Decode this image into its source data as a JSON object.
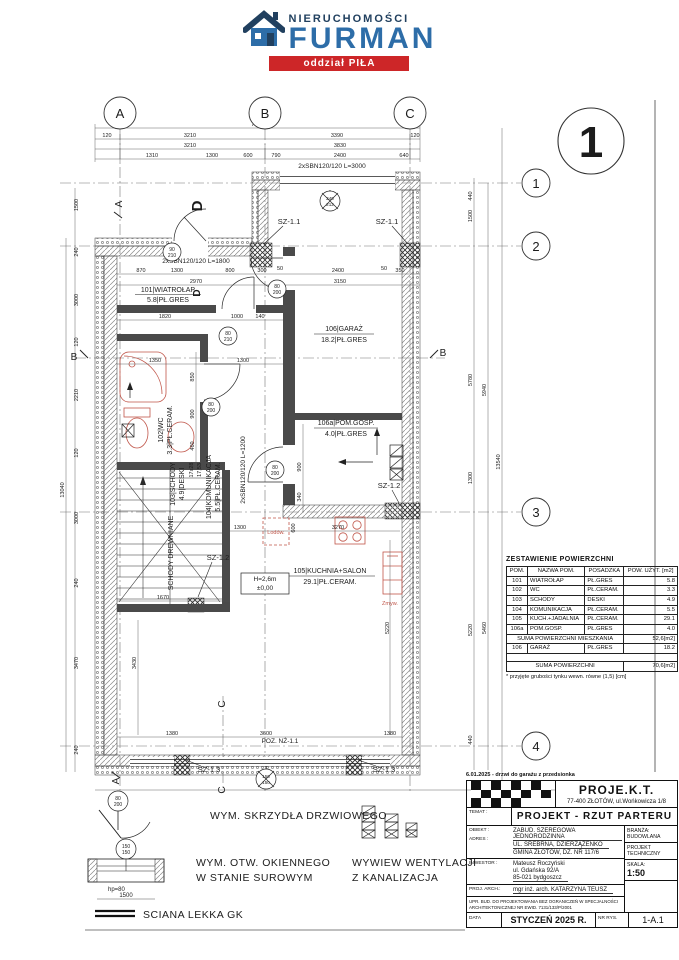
{
  "logo": {
    "brand_top": "NIERUCHOMOŚCI",
    "brand_main": "FURMAN",
    "branch": "oddział PIŁA"
  },
  "sheet": {
    "number": "1"
  },
  "grid": {
    "cols": [
      "A",
      "B",
      "C"
    ],
    "rows": [
      "1",
      "2",
      "3",
      "4"
    ],
    "section_a": "A",
    "section_b": "B",
    "section_c": "C"
  },
  "rooms": [
    {
      "l1": "101|WIATROŁAP",
      "l2": "5.8|PŁ.GRES"
    },
    {
      "l1": "102|WC",
      "l2": "3.3|PŁ.CERAM."
    },
    {
      "l1": "103|SCHODY",
      "l2": "4.9|DESKI"
    },
    {
      "l1": "104|KOMUNIKACJA",
      "l2": "5.5|PŁ.CERAM."
    },
    {
      "l1": "105|KUCHNIA+SALON",
      "l2": "29.1|PŁ.CERAM."
    },
    {
      "l1": "106|GARAŻ",
      "l2": "18.2|PŁ.GRES"
    },
    {
      "l1": "106a|POM.GOSP.",
      "l2": "4.0|PŁ.GRES"
    }
  ],
  "plan": {
    "beams": {
      "b3000": "2xSBN120/120 L=3000",
      "b1800": "2xSBN120/120 L=1800",
      "b1200": "2xSBN120/120 L=1200"
    },
    "sz": {
      "sz11": "SZ-1.1",
      "sz12": "SZ-1.2",
      "sz13": "SZ-1.3"
    },
    "doors": [
      [
        "90",
        "210"
      ],
      [
        "80",
        "210"
      ],
      [
        "80",
        "200"
      ],
      [
        "80",
        "200"
      ],
      [
        "80",
        "200"
      ],
      [
        "240",
        "212"
      ],
      [
        "150",
        "150"
      ]
    ],
    "misc": {
      "h": "H=2,6m",
      "lvl": "±0,00",
      "poz": "POZ. NŻ-1.1",
      "fridge": "Lodów.",
      "sink": "Zmyw.",
      "stairs1": "17x28",
      "stairs2": "17,53",
      "wood_stairs": "SCHODY DREWNIANE",
      "d": "D"
    },
    "dims": {
      "top_total": "7040",
      "top_r2": [
        "120",
        "3210",
        "3390",
        "120"
      ],
      "top_r3": [
        "3210",
        "3830"
      ],
      "top_r4": [
        "1310",
        "1300",
        "600",
        "790",
        "2400",
        "640"
      ],
      "in_r1": [
        "870",
        "1300",
        "800",
        "300",
        "50",
        "2400",
        "50",
        "350"
      ],
      "in_r2": [
        "2970",
        "3150"
      ],
      "in_r3": [
        "1820",
        "1000",
        "140"
      ],
      "kitchen": [
        "1300",
        "600",
        "3270",
        "1670",
        "5220"
      ],
      "wc": [
        "1350",
        "1300",
        "850",
        "900",
        "460"
      ],
      "gar": [
        "900",
        "340"
      ],
      "bottom": [
        "1380",
        "3600",
        "1380"
      ],
      "bottom_total": "7040",
      "left": [
        "1500",
        "240",
        "3000",
        "120",
        "2210",
        "120",
        "3000",
        "240",
        "3470",
        "240"
      ],
      "left_total": "13040",
      "left_inner": "3430",
      "right": [
        "440",
        "1500",
        "5780",
        "1300",
        "5220",
        "440"
      ],
      "right2": [
        "5940",
        "5460"
      ],
      "right_total": "13540"
    }
  },
  "table": {
    "title": "ZESTAWIENIE POWIERZCHNI",
    "headers": [
      "POM.",
      "NAZWA POM.",
      "POSADZKA",
      "POW. UŻYT. [m2]"
    ],
    "rows": [
      [
        "101",
        "WIATROŁAP",
        "PŁ.GRES",
        "5.8"
      ],
      [
        "102",
        "WC",
        "PŁ.CERAM.",
        "3.3"
      ],
      [
        "103",
        "SCHODY",
        "DESKI",
        "4.9"
      ],
      [
        "104",
        "KOMUNIKACJA",
        "PŁ.CERAM.",
        "5.5"
      ],
      [
        "105",
        "KUCH.+JADALNIA",
        "PŁ.CERAM.",
        "29.1"
      ],
      [
        "106a",
        "POM.GOSP.",
        "PŁ.GRES",
        "4.0"
      ]
    ],
    "sum1_label": "SUMA POWIERZCHNI MIESZKANIA",
    "sum1_value": "52,6[m2]",
    "garage_row": [
      "106",
      "GARAŻ",
      "PŁ.GRES",
      "18.2"
    ],
    "sum2_label": "SUMA POWIERZCHNI",
    "sum2_value": "70,6[m2]",
    "footnote": "* przyjęte grubości tynku wewn. równe (1,5) [cm]"
  },
  "legend": {
    "door": "WYM. SKRZYDŁA DRZWIOWEGO",
    "window1": "WYM. OTW. OKIENNEGO",
    "window2": "W STANIE SUROWYM",
    "vent1": "WYWIEW WENTYLACJI",
    "vent2": "Z KANALIZACJA",
    "wall": "SCIANA LEKKA GK",
    "hp": "hp=80",
    "w1500": "1500",
    "door_size": [
      "80",
      "200"
    ],
    "window_size": [
      "150",
      "150"
    ]
  },
  "titleblock": {
    "note": "6.01.2025 - drzwi do garażu z przedsionka",
    "company": "PROJE.K.T.",
    "company_addr": "77-400 ZŁOTÓW, ul.Wońkowicza 1/8",
    "temat_label": "TEMAT :",
    "temat": "PROJEKT - RZUT PARTERU",
    "obiekt_label": "OBIEKT :",
    "adres_label": "ADRES :",
    "obiekt": "ZABUD. SZEREGOWA JEDNORODZINNA",
    "adres1": "UL. SREBRNA, DZIERZĄŻENKO",
    "adres2": "GMINA ZŁOTÓW, DZ. NR 117/6",
    "branza_label": "BRANŻA:",
    "branza": "BUDOWLANA",
    "projekt1": "PROJEKT",
    "projekt2": "TECHNICZNY",
    "inwestor_label": "INWESTOR :",
    "inwestor1": "Mateusz Roczyński",
    "inwestor2": "ul. Gdańska 92/A",
    "inwestor3": "85-021 bydgoszcz",
    "skala_label": "SKALA:",
    "skala": "1:50",
    "arch_label": "PROJ. ARCH.:",
    "arch": "mgr inż. arch. KATARZYNA TEUSZ",
    "upr1": "UPR. BUD. DO PROJEKTOWANIA BEZ OGRANICZEŃ W SPECJALNOŚCI",
    "upr2": "ARCHITEKTONICZNEJ NR EWID. 7131/133/P/2001",
    "data_label": "DATA",
    "data": "STYCZEŃ 2025 R.",
    "nr_label": "NR RYS.",
    "nr": "1-A.1"
  }
}
